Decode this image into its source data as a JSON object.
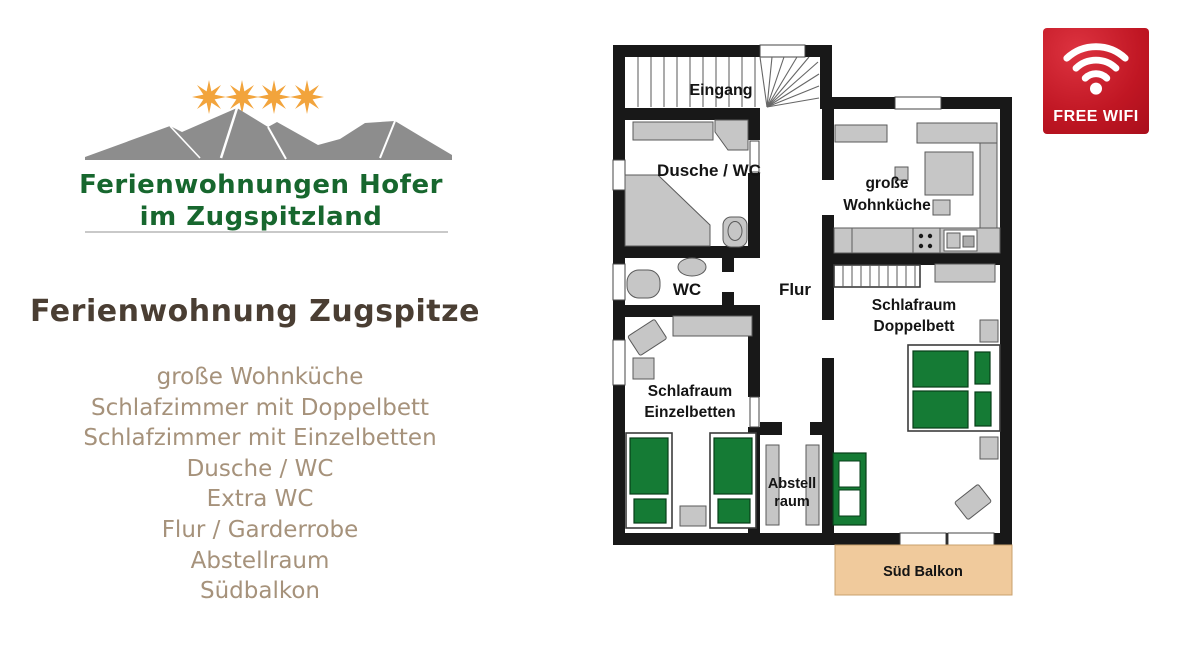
{
  "logo": {
    "stars": 4,
    "star_color": "#f2a43c",
    "mountain_color": "#8d8d8d",
    "line1": "Ferienwohnungen Hofer",
    "line2": "im Zugspitzland",
    "text_color": "#17672e"
  },
  "listing": {
    "title": "Ferienwohnung Zugspitze",
    "features": [
      "große Wohnküche",
      "Schlafzimmer mit Doppelbett",
      "Schlafzimmer mit Einzelbetten",
      "Dusche / WC",
      "Extra WC",
      "Flur / Garderrobe",
      "Abstellraum",
      "Südbalkon"
    ]
  },
  "wifi_badge": {
    "label": "FREE WIFI",
    "background": "#c01623"
  },
  "floorplan": {
    "labels": {
      "eingang": "Eingang",
      "dusche_wc": "Dusche / WC",
      "kueche_1": "große",
      "kueche_2": "Wohnküche",
      "wc": "WC",
      "flur": "Flur",
      "doppelbett_1": "Schlafraum",
      "doppelbett_2": "Doppelbett",
      "einzelbetten_1": "Schlafraum",
      "einzelbetten_2": "Einzelbetten",
      "abstellraum_1": "Abstell",
      "abstellraum_2": "raum",
      "balkon": "Süd Balkon"
    },
    "colors": {
      "wall": "#181818",
      "furniture": "#c6c6c6",
      "bed": "#157b35",
      "balcony": "#f0ca9c"
    }
  }
}
